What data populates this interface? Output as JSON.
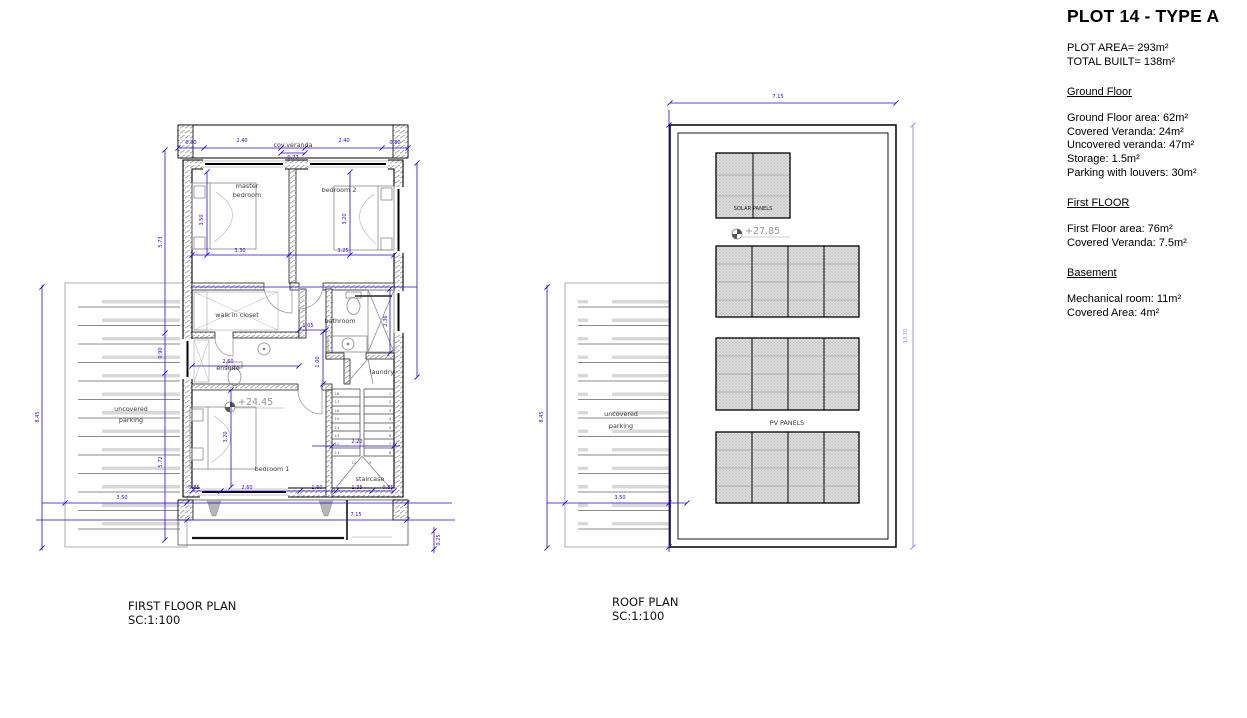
{
  "colors": {
    "dimension_blue": "#3305cf",
    "dimension_light_purple": "#9087e2",
    "wall_hatch_gray": "#9a9a9a",
    "fixture_gray": "#8a8a8a",
    "level_text_gray": "#949494"
  },
  "first_floor_plan": {
    "title": "FIRST FLOOR PLAN",
    "scale": "SC:1:100",
    "labels": {
      "veranda": "cov.veranda",
      "parking_l1": "uncovered",
      "parking_l2": "parking",
      "master_l1": "master",
      "master_l2": "bedroom",
      "bedroom2": "bedroom 2",
      "closet": "walk in closet",
      "bathroom": "bathroom",
      "ensuite": "ensuite",
      "laundry": "laundry",
      "bedroom1": "bedroom 1",
      "staircase": "staircase"
    },
    "level_mark": "+24.45",
    "dims": {
      "top": [
        "0.80",
        "2.40",
        "2.40",
        "0.80"
      ],
      "veranda_depth": "0.77",
      "side_outer": "8.45",
      "side_chain": [
        "5.73",
        "0.90",
        "5.72"
      ],
      "parking_width": "3.50",
      "master_depth": "3.50",
      "master_width": "3.30",
      "bedroom2_depth": "3.20",
      "bedroom2_width": "3.25",
      "hall_width": "1.05",
      "shower_depth": "2.36",
      "ensuite_width": "2.60",
      "hall_depth": "1.00",
      "bedroom1_depth": "3.20",
      "stair_width": "2.20",
      "bottom": [
        "0.85",
        "2.60",
        "1.60",
        "1.35",
        "0.85"
      ],
      "total_width": "7.15",
      "edge": "0.25"
    },
    "stairs": {
      "left": [
        "18",
        "17",
        "16",
        "15",
        "14",
        "13",
        "12",
        "11"
      ],
      "right": [
        "1",
        "2",
        "3",
        "4",
        "5",
        "6",
        "7",
        "8"
      ],
      "mid": [
        "10",
        "9"
      ]
    }
  },
  "roof_plan": {
    "title": "ROOF PLAN",
    "scale": "SC:1:100",
    "labels": {
      "parking_l1": "uncovered",
      "parking_l2": "parking",
      "solar": "SOLAR PANELS",
      "pv": "PV PANELS"
    },
    "level_mark": "+27.85",
    "dims": {
      "total_width": "7.15",
      "total_depth": "13.70",
      "parking_depth": "8.45",
      "parking_width": "3.50"
    }
  },
  "info_panel": {
    "title": "PLOT 14 - TYPE A",
    "plot_area": "PLOT AREA= 293m²",
    "total_built": "TOTAL BUILT= 138m²",
    "sections": [
      {
        "heading": "Ground Floor",
        "lines": [
          "Ground Floor area: 62m²",
          "Covered Veranda: 24m²",
          "Uncovered veranda: 47m²",
          "Storage: 1.5m²",
          "Parking with louvers: 30m²"
        ]
      },
      {
        "heading": "First FLOOR",
        "lines": [
          "First Floor area: 76m²",
          "Covered Veranda: 7.5m²"
        ]
      },
      {
        "heading": "Basement",
        "lines": [
          "Mechanical room: 11m²",
          "Covered Area: 4m²"
        ]
      }
    ]
  }
}
